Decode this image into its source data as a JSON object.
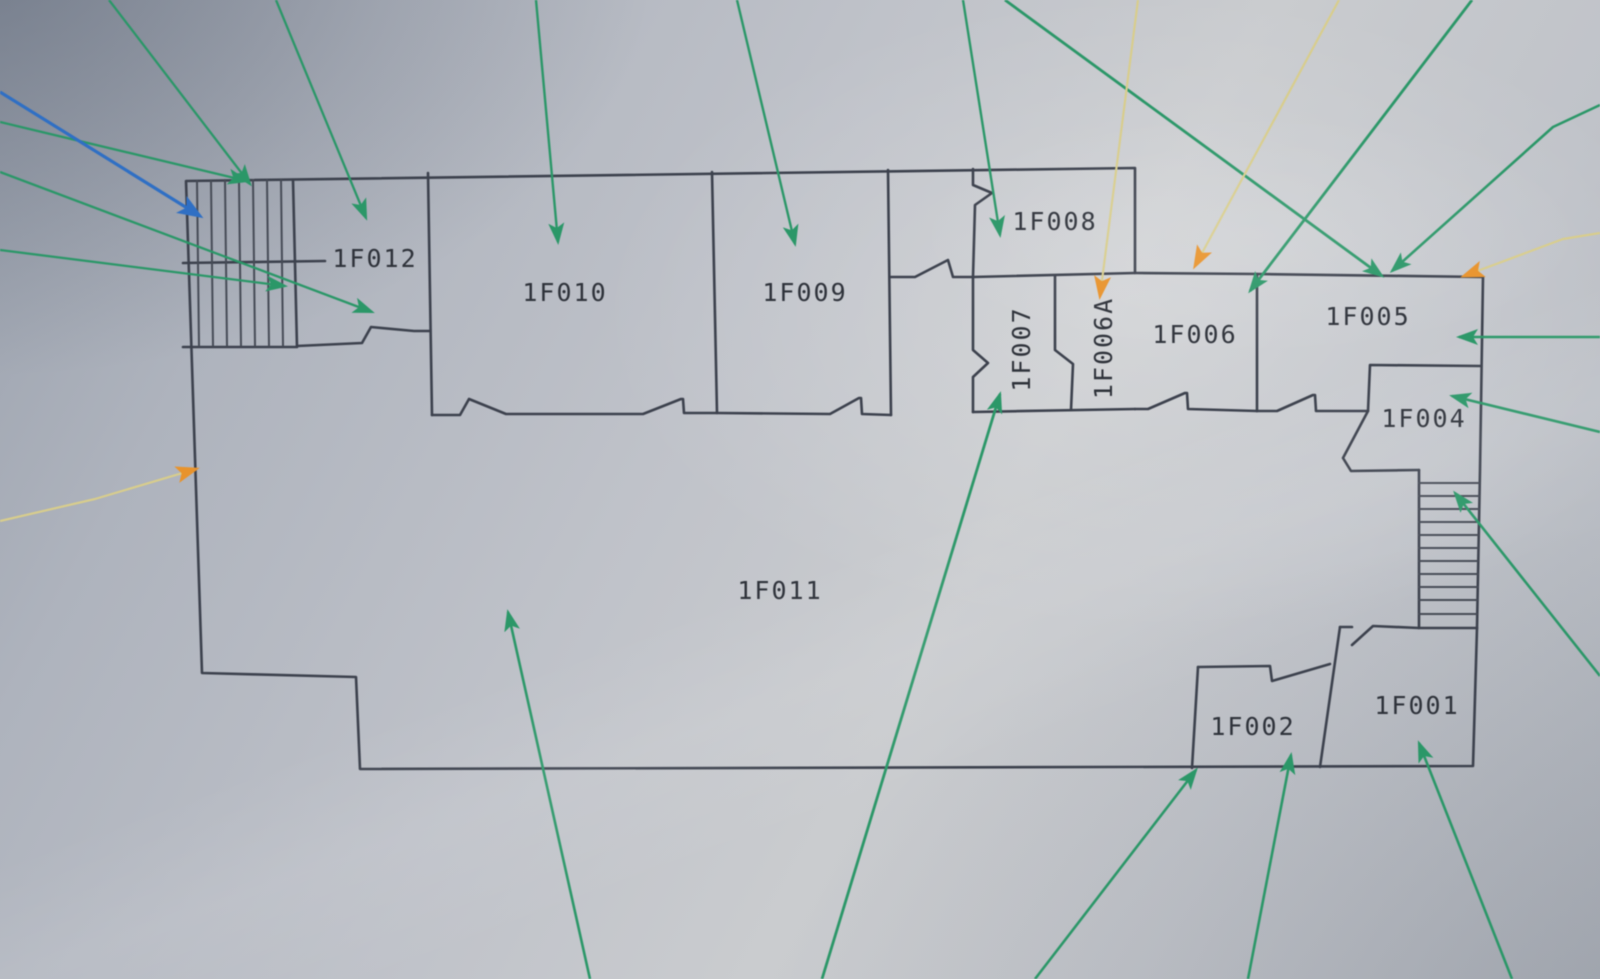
{
  "plan": {
    "floor": "1F",
    "rooms": [
      {
        "label": "1F001"
      },
      {
        "label": "1F002"
      },
      {
        "label": "1F004"
      },
      {
        "label": "1F005"
      },
      {
        "label": "1F006"
      },
      {
        "label": "1F006A"
      },
      {
        "label": "1F007"
      },
      {
        "label": "1F008"
      },
      {
        "label": "1F009"
      },
      {
        "label": "1F010"
      },
      {
        "label": "1F011"
      },
      {
        "label": "1F012"
      }
    ]
  },
  "colors": {
    "green_line": "#2b9768",
    "blue_line": "#2f6fc4",
    "yellow_line": "#d8cd8c",
    "green_head": "#2b9768",
    "blue_head": "#2f6fc4",
    "yellow_head": "#e8932c",
    "wall": "#3c414d",
    "paper": "#c0c3c9",
    "label_text": "#2e323a"
  },
  "arrows": [
    {
      "color": "green",
      "target": "stairs-left-top",
      "points": "109,0 250,184",
      "width": 2.3
    },
    {
      "color": "green",
      "target": "room-1f012-upper",
      "points": "276,0 366,218",
      "width": 2.3
    },
    {
      "color": "green",
      "target": "stairs-left-edge",
      "points": "0,122 247,181",
      "width": 2.3
    },
    {
      "color": "green",
      "target": "stairs-left-mid",
      "points": "0,250 285,286",
      "width": 2.3
    },
    {
      "color": "green",
      "target": "room-1f012-door",
      "points": "0,172 372,312",
      "width": 2.3
    },
    {
      "color": "green",
      "target": "room-1f010",
      "points": "536,0 558,242",
      "width": 2.4
    },
    {
      "color": "green",
      "target": "room-1f009",
      "points": "737,0 795,244",
      "width": 2.4
    },
    {
      "color": "green",
      "target": "room-1f008",
      "points": "963,0 1000,235",
      "width": 2.4
    },
    {
      "color": "green",
      "target": "room-1f005-top-a",
      "points": "1005,0 1382,276",
      "width": 2.8
    },
    {
      "color": "green",
      "target": "room-1f006-top",
      "points": "1472,0 1250,291",
      "width": 2.8
    },
    {
      "color": "green",
      "target": "room-1f005-top-b",
      "points": "1600,105 1553,127 1392,271",
      "width": 2.6
    },
    {
      "color": "green",
      "target": "room-1f005-right",
      "points": "1600,337 1459,337",
      "width": 2.6
    },
    {
      "color": "green",
      "target": "room-1f004",
      "points": "1600,432 1452,396",
      "width": 2.6
    },
    {
      "color": "green",
      "target": "stairs-right",
      "points": "1600,676 1455,493",
      "width": 2.6
    },
    {
      "color": "green",
      "target": "room-1f011",
      "points": "590,979 508,612",
      "width": 2.6
    },
    {
      "color": "green",
      "target": "room-1f007",
      "points": "822,979 1000,394",
      "width": 2.8
    },
    {
      "color": "green",
      "target": "room-1f002-corner",
      "points": "1035,979 1196,770",
      "width": 2.6
    },
    {
      "color": "green",
      "target": "room-1f002",
      "points": "1248,979 1291,755",
      "width": 2.6
    },
    {
      "color": "green",
      "target": "room-1f001",
      "points": "1512,979 1419,743",
      "width": 2.6
    },
    {
      "color": "blue",
      "target": "stairs-left-blue",
      "points": "0,92 200,216",
      "width": 3.2
    },
    {
      "color": "yellow",
      "target": "left-wall",
      "points": "0,521 95,499 196,469",
      "width": 2.2
    },
    {
      "color": "yellow",
      "target": "room-1f006a",
      "points": "1138,0 1100,296",
      "width": 2.2
    },
    {
      "color": "yellow",
      "target": "room-1f006-wall",
      "points": "1339,0 1195,266",
      "width": 2.2
    },
    {
      "color": "yellow",
      "target": "room-1f005-corner",
      "points": "1600,233 1563,239 1464,276",
      "width": 2.2
    }
  ]
}
